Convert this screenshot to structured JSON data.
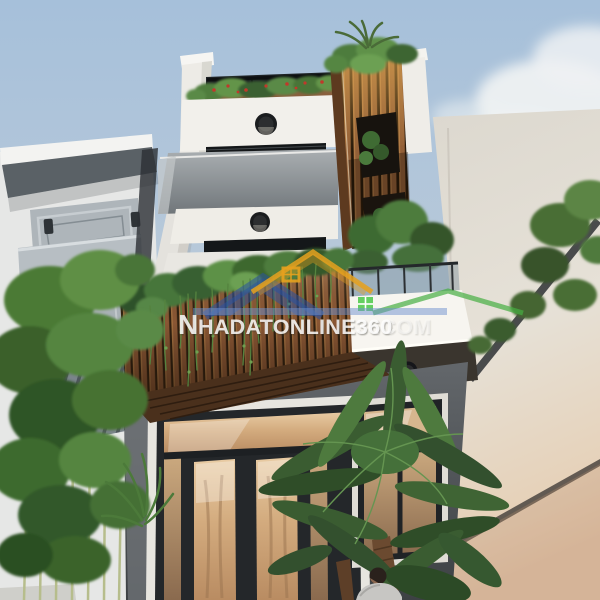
{
  "image": {
    "kind": "3d-architectural-exterior-render",
    "subject": "modern narrow multi-storey townhouse facade, worm's-eye view, with wood slat balcony boxes, hanging vines, palm and bamboo plants, neighbouring white buildings and pale blue sky",
    "width": 600,
    "height": 600
  },
  "watermark": {
    "brand_initial": "N",
    "brand_rest": "HADATONLINE360",
    "suffix": ".COM",
    "text_color": "#ffffff",
    "underline_bar_color": "#6e8fcd",
    "logo_houses": [
      {
        "name": "orange-house-outline",
        "color": "#e5a11e"
      },
      {
        "name": "blue-house-roof",
        "color": "#2e5cab"
      },
      {
        "name": "green-house-outline",
        "color": "#46ae42"
      }
    ]
  },
  "palette": {
    "sky_top": "#a6c0da",
    "sky_low": "#c6cfd8",
    "cloud": "#f2f4f4",
    "main_white": "#f2f0eb",
    "concrete_band": "#8d9396",
    "wood_slat": "#8a5734",
    "wood_dark_gap": "#30200f",
    "wood_soffit": "#4a301c",
    "dark_window": "#141719",
    "ground_wall_dark": "#53575b",
    "entry_glass_amber": "#caa078",
    "right_wall": "#e2ddd3",
    "left_building_gray": "#b3bac0",
    "foliage_green": "#46763a",
    "flower_red": "#c0392b"
  },
  "lights": {
    "round_ceiling_downlights": 3
  },
  "figures": {
    "person_near_entry": 1
  }
}
